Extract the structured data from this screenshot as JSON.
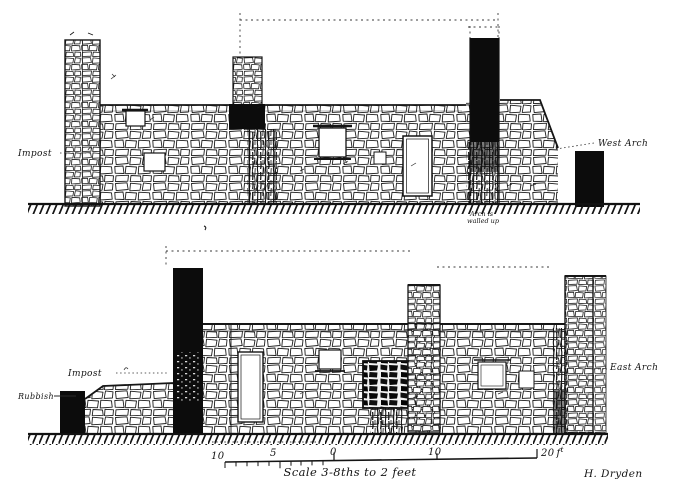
{
  "drawing": {
    "upper_elevation": {
      "impost_label": "Impost",
      "west_arch_label": "West Arch",
      "note_line1": "Arch is",
      "note_line2": "walled up"
    },
    "lower_elevation": {
      "impost_label": "Impost",
      "rubbish_label": "Rubbish",
      "east_arch_label": "East Arch"
    },
    "scalebar": {
      "ticks": [
        {
          "label": "10"
        },
        {
          "label": "5"
        },
        {
          "label": "0"
        },
        {
          "label": "10"
        },
        {
          "label": "20"
        }
      ],
      "unit_main": "f",
      "unit_sup": "t",
      "caption": "Scale 3-8ths to 2 feet"
    },
    "signature": "H. Dryden",
    "colors": {
      "ink": "#161616",
      "paper": "#ffffff",
      "solid_fill": "#0c0c0c"
    }
  }
}
